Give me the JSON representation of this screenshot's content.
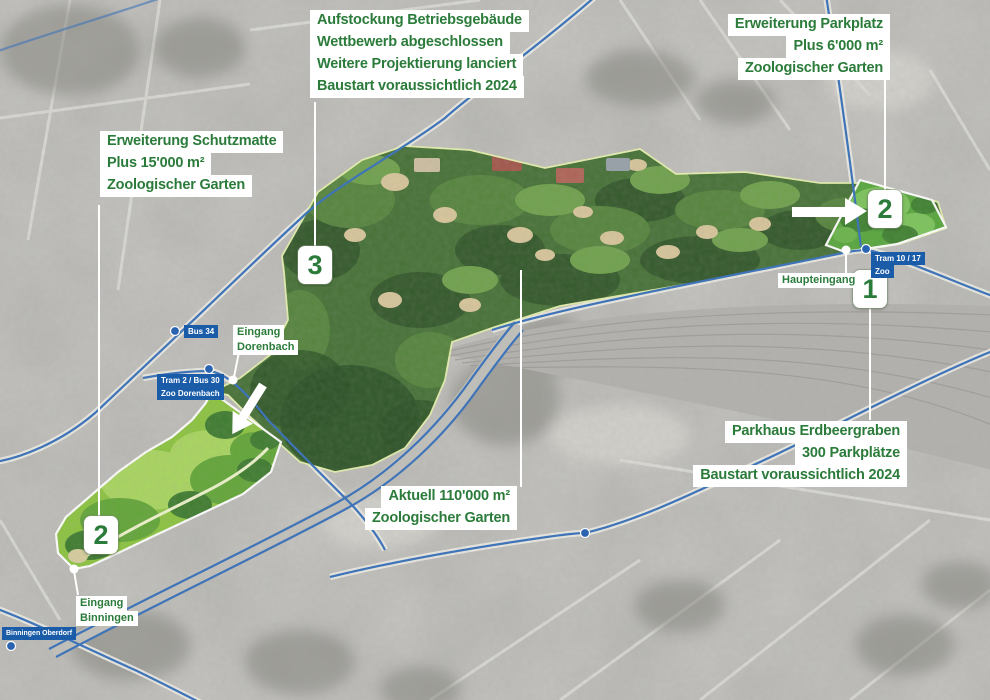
{
  "map_title": "Zoologischer Garten Basel – Erweiterungsplan (Luftbild)",
  "colors": {
    "callout_green": "#2b7b3a",
    "badge_blue": "#1a5ca8",
    "road_blue": "#3f74b8",
    "zoo_outline_yellow": "#e4efad",
    "bright_area_green": "#8cc440",
    "connector_white": "#ffffff"
  },
  "callouts": {
    "aufstockung": {
      "lines": [
        "Aufstockung Betriebsgebäude",
        "Wettbewerb abgeschlossen",
        "Weitere Projektierung lanciert",
        "Baustart voraussichtlich 2024"
      ]
    },
    "parkplatz": {
      "lines": [
        "Erweiterung Parkplatz",
        "Plus 6'000 m²",
        "Zoologischer Garten"
      ]
    },
    "schutzmatte": {
      "lines": [
        "Erweiterung Schutzmatte",
        "Plus 15'000 m²",
        "Zoologischer Garten"
      ]
    },
    "parkhaus": {
      "lines": [
        "Parkhaus Erdbeergraben",
        "300 Parkplätze",
        "Baustart voraussichtlich 2024"
      ]
    },
    "aktuell": {
      "lines": [
        "Aktuell 110'000 m²",
        "Zoologischer Garten"
      ]
    }
  },
  "entrances": {
    "dorenbach": {
      "lines": [
        "Eingang",
        "Dorenbach"
      ]
    },
    "haupteingang": {
      "lines": [
        "Haupteingang"
      ]
    },
    "binningen": {
      "lines": [
        "Eingang",
        "Binningen"
      ]
    }
  },
  "transit": {
    "bus34": {
      "lines": [
        "Bus 34"
      ]
    },
    "zoo_dorenbach": {
      "lines": [
        "Tram 2 / Bus 30",
        "Zoo Dorenbach"
      ]
    },
    "zoo_main": {
      "lines": [
        "Tram 10 / 17",
        "Zoo"
      ]
    },
    "binningen_oberdorf": {
      "lines": [
        "Binningen Oberdorf"
      ]
    }
  },
  "markers": {
    "parkhaus": "1",
    "parkplatz": "2",
    "schutzmatte": "2",
    "aufstockung": "3"
  }
}
